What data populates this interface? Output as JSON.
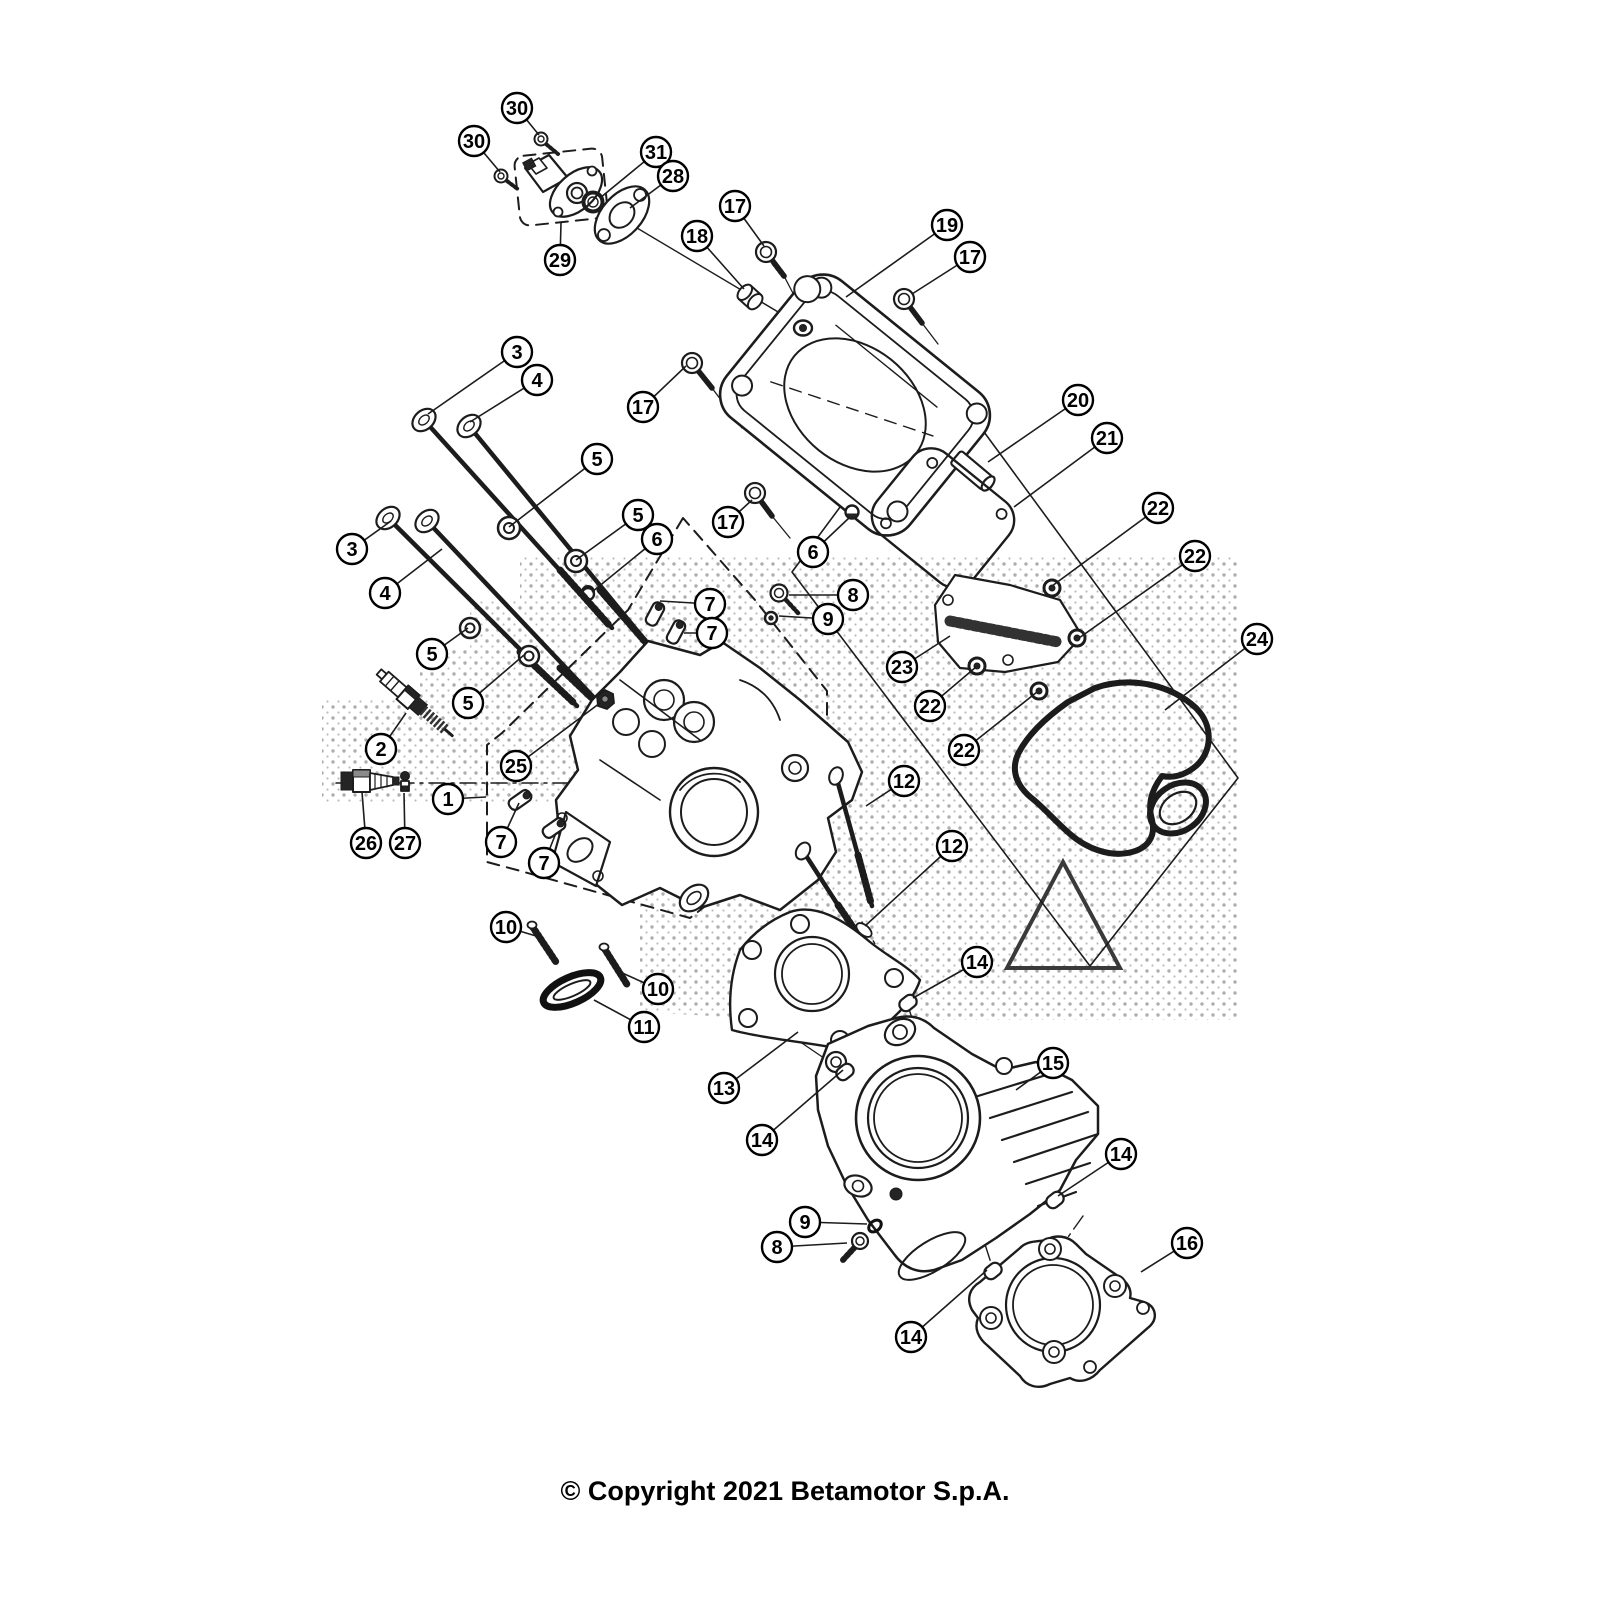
{
  "footer": {
    "copyright": "© Copyright 2021 Betamotor S.p.A."
  },
  "diagram": {
    "canvas": {
      "width": 1600,
      "height": 1600,
      "background": "#ffffff",
      "line_color": "#1c1c1c"
    },
    "callout_style": {
      "radius": 15,
      "font_size": 20,
      "stroke_width": 2.4,
      "leader_width": 1.6,
      "fill": "#ffffff",
      "text_color": "#000000"
    },
    "callouts": [
      {
        "label": "30",
        "cx": 517,
        "cy": 108,
        "ex": 539,
        "ey": 135
      },
      {
        "label": "30",
        "cx": 474,
        "cy": 141,
        "ex": 500,
        "ey": 172
      },
      {
        "label": "31",
        "cx": 656,
        "cy": 152,
        "ex": 600,
        "ey": 198
      },
      {
        "label": "28",
        "cx": 673,
        "cy": 176,
        "ex": 630,
        "ey": 208
      },
      {
        "label": "29",
        "cx": 560,
        "cy": 260,
        "ex": 561,
        "ey": 223
      },
      {
        "label": "17",
        "cx": 735,
        "cy": 206,
        "ex": 764,
        "ey": 246
      },
      {
        "label": "18",
        "cx": 697,
        "cy": 236,
        "ex": 744,
        "ey": 289
      },
      {
        "label": "19",
        "cx": 947,
        "cy": 225,
        "ex": 846,
        "ey": 297
      },
      {
        "label": "17",
        "cx": 970,
        "cy": 257,
        "ex": 912,
        "ey": 294
      },
      {
        "label": "3",
        "cx": 517,
        "cy": 352,
        "ex": 428,
        "ey": 414
      },
      {
        "label": "4",
        "cx": 537,
        "cy": 380,
        "ex": 470,
        "ey": 422
      },
      {
        "label": "17",
        "cx": 643,
        "cy": 407,
        "ex": 686,
        "ey": 366
      },
      {
        "label": "5",
        "cx": 597,
        "cy": 459,
        "ex": 509,
        "ey": 527
      },
      {
        "label": "5",
        "cx": 638,
        "cy": 515,
        "ex": 576,
        "ey": 560
      },
      {
        "label": "6",
        "cx": 657,
        "cy": 539,
        "ex": 592,
        "ey": 592
      },
      {
        "label": "17",
        "cx": 728,
        "cy": 522,
        "ex": 752,
        "ey": 500
      },
      {
        "label": "20",
        "cx": 1078,
        "cy": 400,
        "ex": 988,
        "ey": 462
      },
      {
        "label": "21",
        "cx": 1107,
        "cy": 438,
        "ex": 1014,
        "ey": 507
      },
      {
        "label": "22",
        "cx": 1158,
        "cy": 508,
        "ex": 1052,
        "ey": 586
      },
      {
        "label": "22",
        "cx": 1195,
        "cy": 556,
        "ex": 1079,
        "ey": 638
      },
      {
        "label": "3",
        "cx": 352,
        "cy": 549,
        "ex": 391,
        "ey": 521
      },
      {
        "label": "4",
        "cx": 385,
        "cy": 593,
        "ex": 442,
        "ey": 549
      },
      {
        "label": "5",
        "cx": 432,
        "cy": 654,
        "ex": 468,
        "ey": 628
      },
      {
        "label": "5",
        "cx": 468,
        "cy": 703,
        "ex": 524,
        "ey": 655
      },
      {
        "label": "7",
        "cx": 710,
        "cy": 604,
        "ex": 660,
        "ey": 601
      },
      {
        "label": "7",
        "cx": 712,
        "cy": 633,
        "ex": 684,
        "ey": 633
      },
      {
        "label": "2",
        "cx": 381,
        "cy": 749,
        "ex": 406,
        "ey": 713
      },
      {
        "label": "25",
        "cx": 516,
        "cy": 766,
        "ex": 600,
        "ey": 703
      },
      {
        "label": "8",
        "cx": 853,
        "cy": 595,
        "ex": 789,
        "ey": 595
      },
      {
        "label": "9",
        "cx": 828,
        "cy": 619,
        "ex": 779,
        "ey": 616
      },
      {
        "label": "6",
        "cx": 813,
        "cy": 552,
        "ex": 850,
        "ey": 517
      },
      {
        "label": "23",
        "cx": 902,
        "cy": 667,
        "ex": 950,
        "ey": 636
      },
      {
        "label": "22",
        "cx": 930,
        "cy": 706,
        "ex": 976,
        "ey": 667
      },
      {
        "label": "22",
        "cx": 964,
        "cy": 750,
        "ex": 1037,
        "ey": 692
      },
      {
        "label": "24",
        "cx": 1257,
        "cy": 639,
        "ex": 1165,
        "ey": 710
      },
      {
        "label": "1",
        "cx": 448,
        "cy": 799,
        "ex": 486,
        "ey": 797
      },
      {
        "label": "26",
        "cx": 366,
        "cy": 843,
        "ex": 362,
        "ey": 792
      },
      {
        "label": "27",
        "cx": 405,
        "cy": 843,
        "ex": 404,
        "ey": 793
      },
      {
        "label": "7",
        "cx": 501,
        "cy": 842,
        "ex": 519,
        "ey": 803
      },
      {
        "label": "7",
        "cx": 544,
        "cy": 863,
        "ex": 556,
        "ey": 833
      },
      {
        "label": "12",
        "cx": 904,
        "cy": 781,
        "ex": 866,
        "ey": 806
      },
      {
        "label": "12",
        "cx": 952,
        "cy": 846,
        "ex": 865,
        "ey": 926
      },
      {
        "label": "10",
        "cx": 506,
        "cy": 927,
        "ex": 536,
        "ey": 936
      },
      {
        "label": "10",
        "cx": 658,
        "cy": 989,
        "ex": 620,
        "ey": 972
      },
      {
        "label": "11",
        "cx": 644,
        "cy": 1027,
        "ex": 594,
        "ey": 1000
      },
      {
        "label": "13",
        "cx": 724,
        "cy": 1088,
        "ex": 798,
        "ey": 1032
      },
      {
        "label": "14",
        "cx": 977,
        "cy": 962,
        "ex": 913,
        "ey": 998
      },
      {
        "label": "14",
        "cx": 762,
        "cy": 1140,
        "ex": 843,
        "ey": 1070
      },
      {
        "label": "15",
        "cx": 1053,
        "cy": 1063,
        "ex": 1016,
        "ey": 1090
      },
      {
        "label": "14",
        "cx": 1121,
        "cy": 1154,
        "ex": 1058,
        "ey": 1196
      },
      {
        "label": "9",
        "cx": 805,
        "cy": 1222,
        "ex": 867,
        "ey": 1224
      },
      {
        "label": "8",
        "cx": 777,
        "cy": 1247,
        "ex": 847,
        "ey": 1243
      },
      {
        "label": "16",
        "cx": 1187,
        "cy": 1243,
        "ex": 1141,
        "ey": 1272
      },
      {
        "label": "14",
        "cx": 911,
        "cy": 1337,
        "ex": 987,
        "ey": 1270
      }
    ]
  }
}
